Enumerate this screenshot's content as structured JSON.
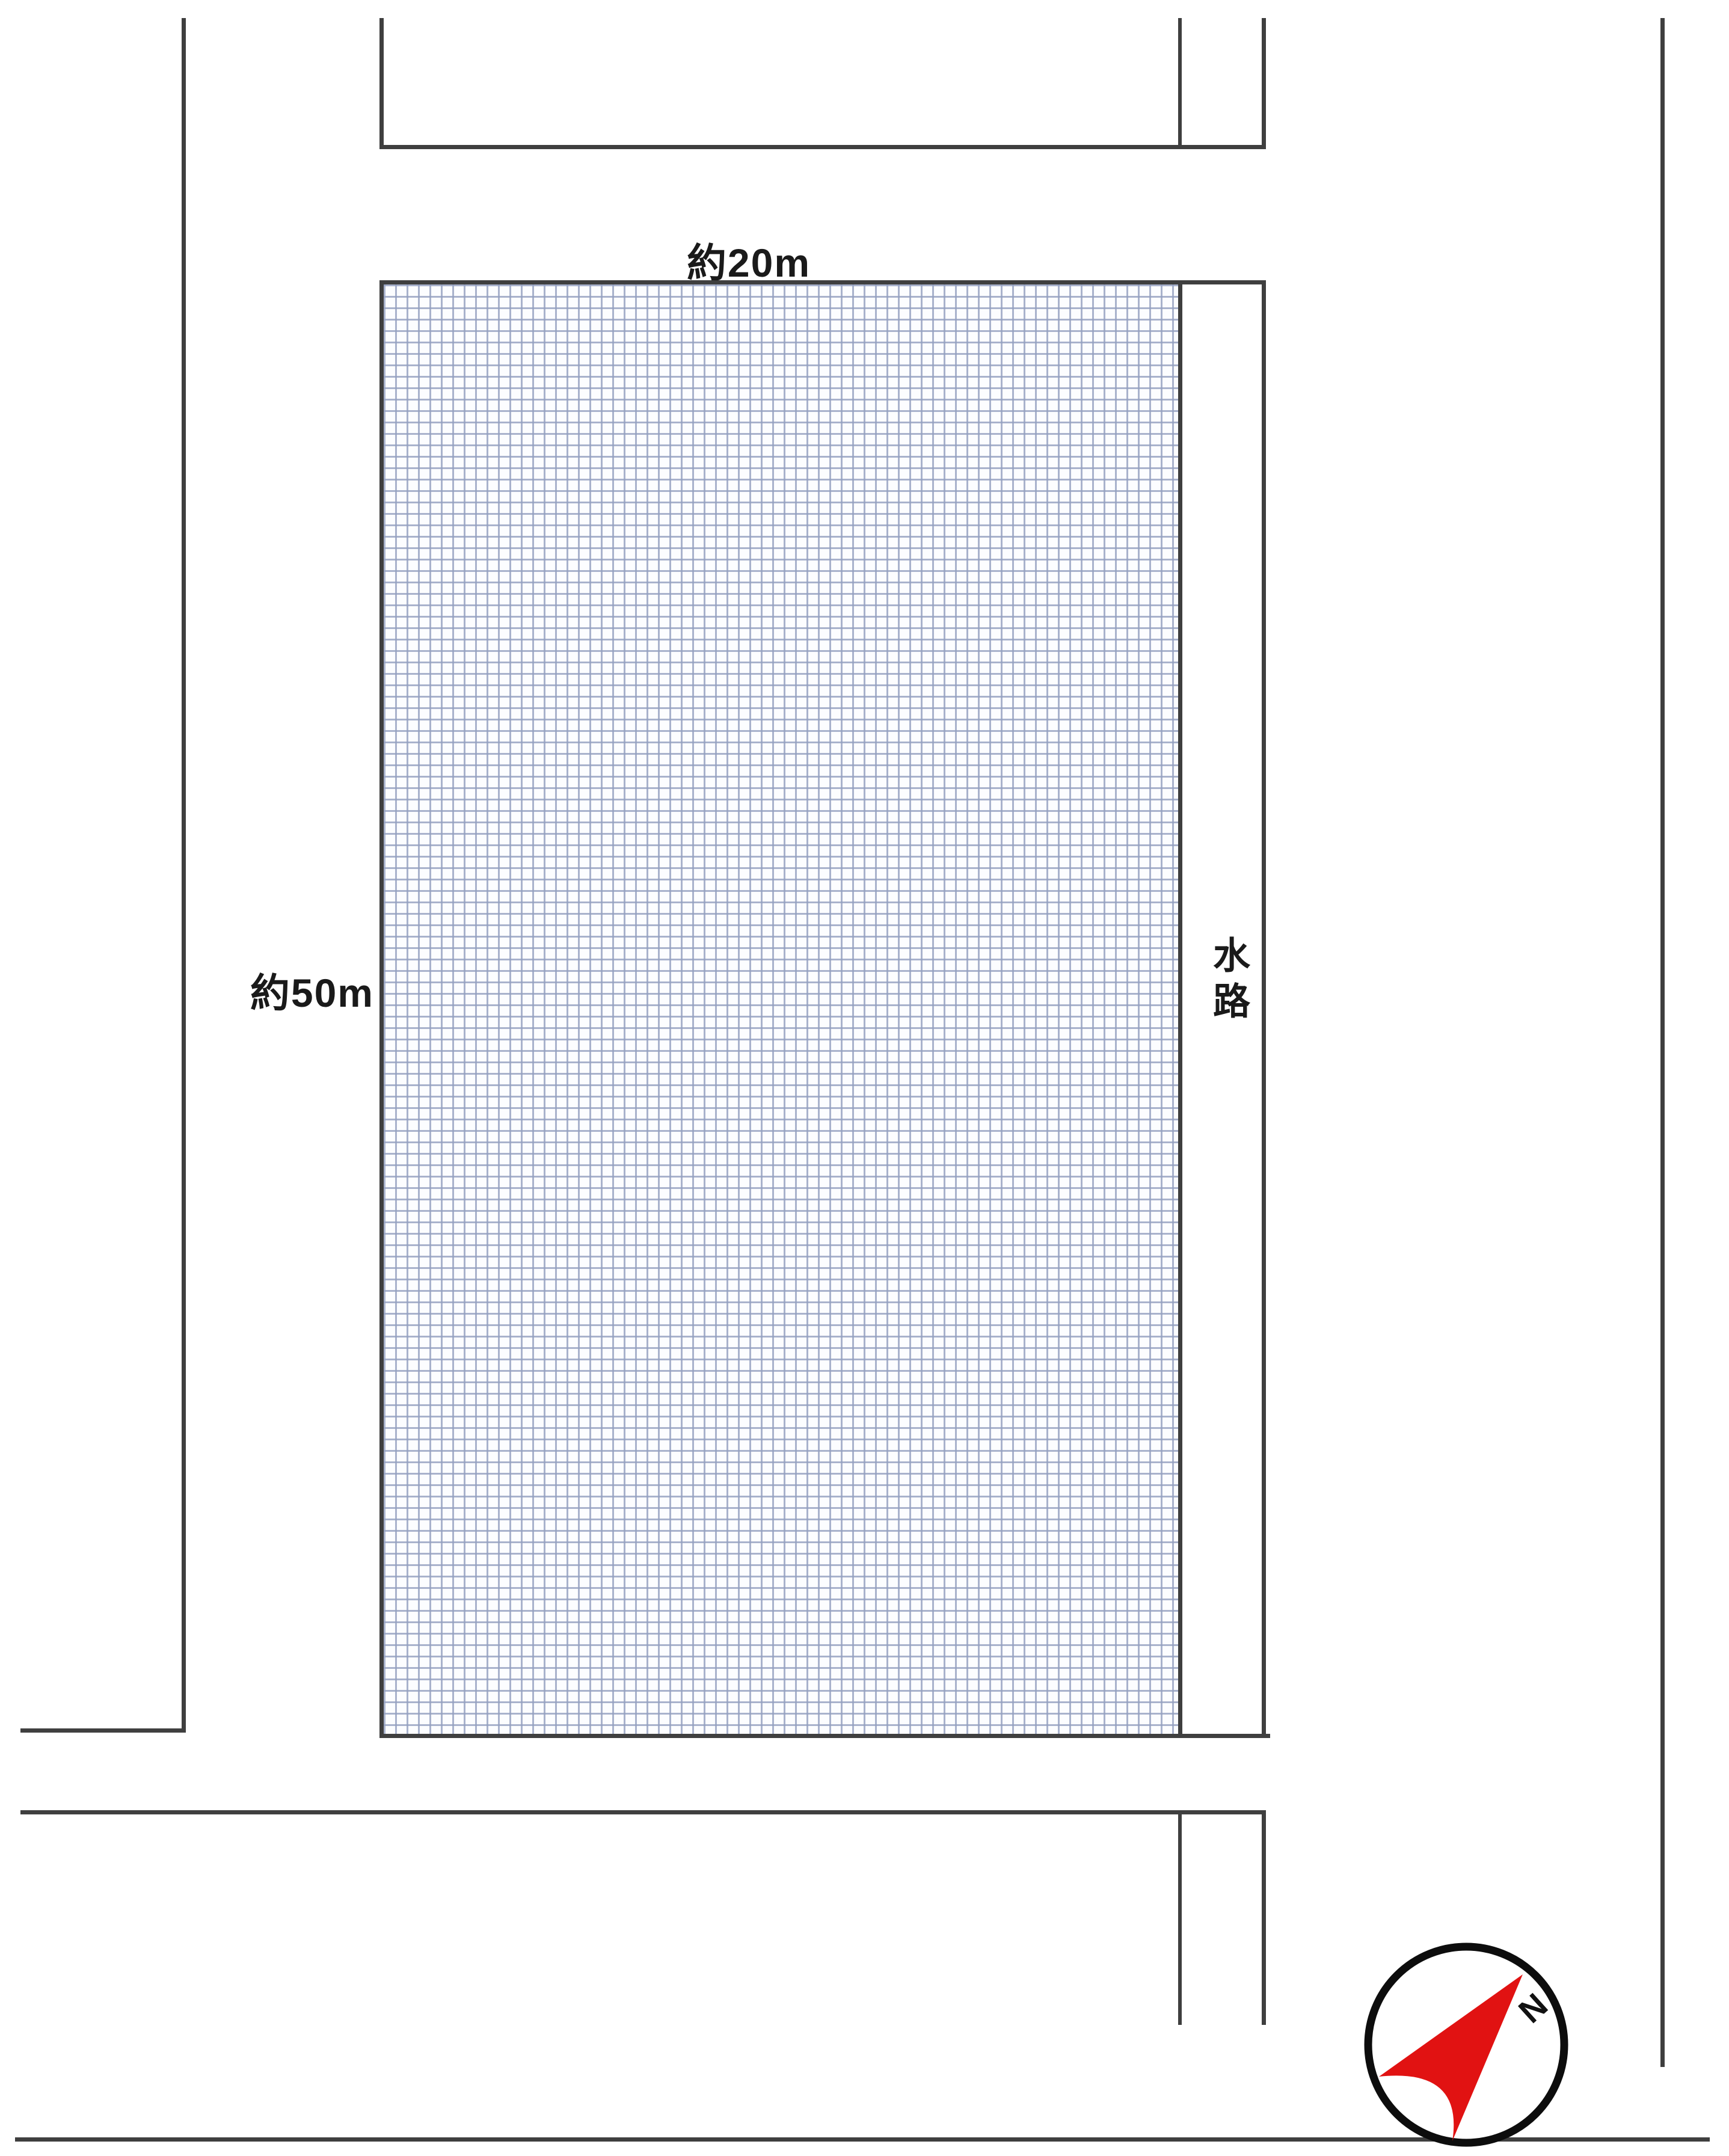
{
  "plot": {
    "top_dimension_label": "約20m",
    "left_dimension_label": "約50m"
  },
  "waterway": {
    "label": "水路"
  },
  "compass": {
    "north_label": "N"
  },
  "colors": {
    "boundary_line": "#3f3f3f",
    "grid_line": "#94a0c0",
    "grid_background": "#fcfdff",
    "text": "#1a1a1a",
    "compass_arrow_red": "#e11212",
    "compass_ring": "#0d0d0d"
  }
}
